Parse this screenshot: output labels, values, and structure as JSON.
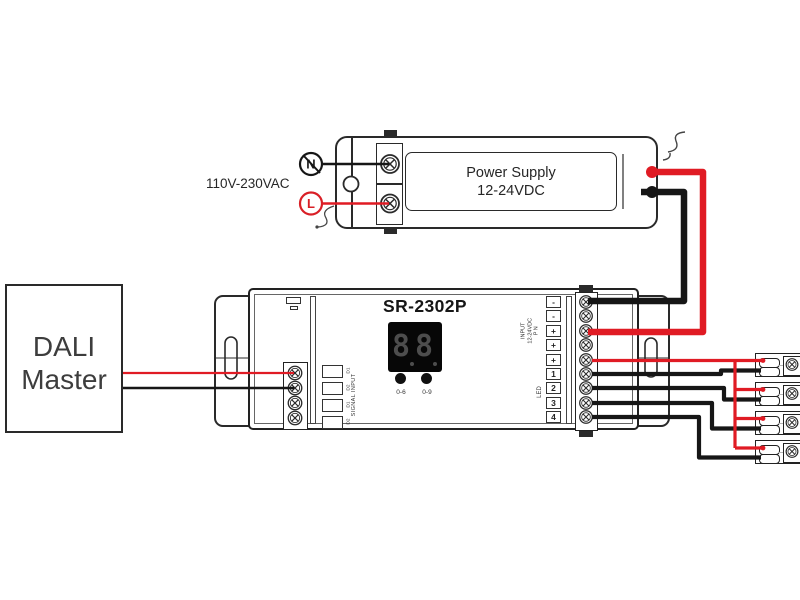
{
  "dali_master": {
    "line1": "DALI",
    "line2": "Master"
  },
  "ac_input": {
    "voltage_label": "110V-230VAC",
    "neutral": "N",
    "live": "L"
  },
  "power_supply": {
    "name_line1": "Power Supply",
    "name_line2": "12-24VDC"
  },
  "controller": {
    "model": "SR-2302P",
    "display": {
      "value": "8.8.",
      "digit1": "8",
      "digit2": "8"
    },
    "buttons": {
      "left": "0-6",
      "right": "0-9"
    },
    "signal_input": {
      "label": "SIGNAL INPUT",
      "channels": [
        "D1",
        "D2",
        "D1",
        "D2"
      ]
    },
    "power_legend": {
      "line1": "INPUT",
      "line2": "12-24VDC",
      "line3": "P N"
    },
    "led_legend": "LED",
    "terminal_labels": [
      "-",
      "-",
      "+",
      "+",
      "+",
      "1",
      "2",
      "3",
      "4"
    ]
  },
  "colors": {
    "wire_red": "#e01b24",
    "wire_black": "#161616"
  }
}
